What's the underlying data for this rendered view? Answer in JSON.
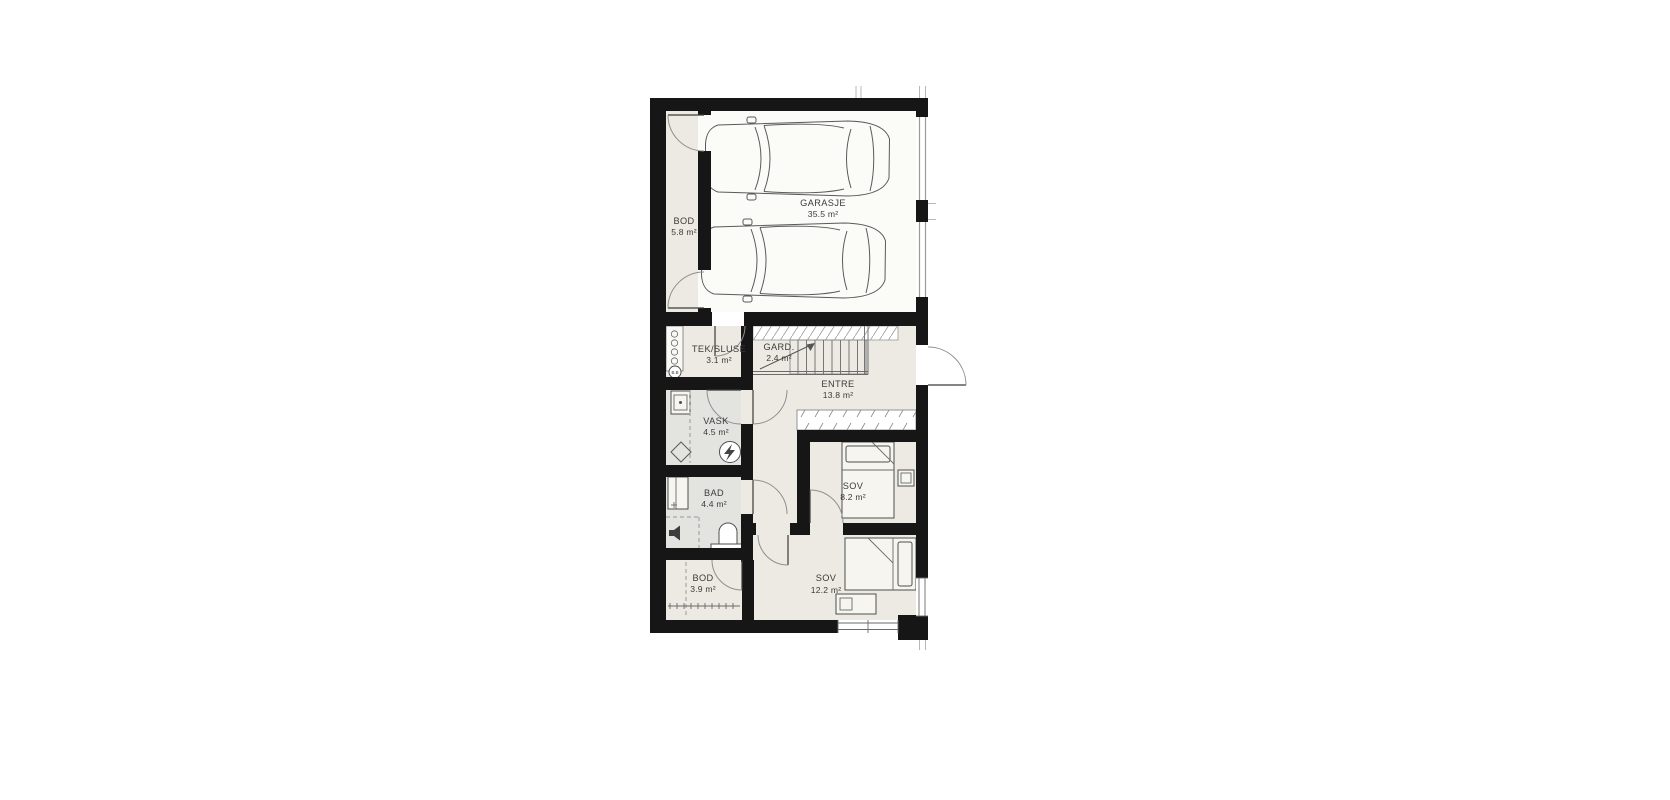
{
  "page": {
    "background": "#ffffff"
  },
  "floorplan": {
    "rooms": [
      {
        "id": "bod-garage",
        "name": "BOD",
        "area": "5.8 m²"
      },
      {
        "id": "garasje",
        "name": "GARASJE",
        "area": "35.5 m²"
      },
      {
        "id": "tek-sluse",
        "name": "TEK/SLUSE",
        "area": "3.1 m²"
      },
      {
        "id": "gard",
        "name": "GARD.",
        "area": "2.4 m²"
      },
      {
        "id": "entre",
        "name": "ENTRE",
        "area": "13.8 m²"
      },
      {
        "id": "vask",
        "name": "VASK",
        "area": "4.5 m²"
      },
      {
        "id": "bad",
        "name": "BAD",
        "area": "4.4 m²"
      },
      {
        "id": "sov-1",
        "name": "SOV",
        "area": "8.2 m²"
      },
      {
        "id": "bod-inner",
        "name": "BOD",
        "area": "3.9 m²"
      },
      {
        "id": "sov-2",
        "name": "SOV",
        "area": "12.2 m²"
      }
    ],
    "annotations": {
      "bb_circle": "B.B"
    },
    "icons": [
      "car-icon",
      "stairs-icon",
      "stair-direction-arrow-icon",
      "bed-icon",
      "nightstand-icon",
      "wardrobe-icon",
      "washer-icon",
      "water-heater-icon",
      "floor-drain-icon",
      "shower-cabinet-icon",
      "toilet-icon",
      "drain-icon",
      "door-swing-icon",
      "window-icon"
    ],
    "colors": {
      "wall": "#161616",
      "floor": "#eceae2",
      "wet_floor": "#e3e3e0",
      "garage_floor": "#fbfbf8",
      "closet_fill": "#f6f5f0",
      "furniture_line": "#4f4f4f"
    }
  }
}
